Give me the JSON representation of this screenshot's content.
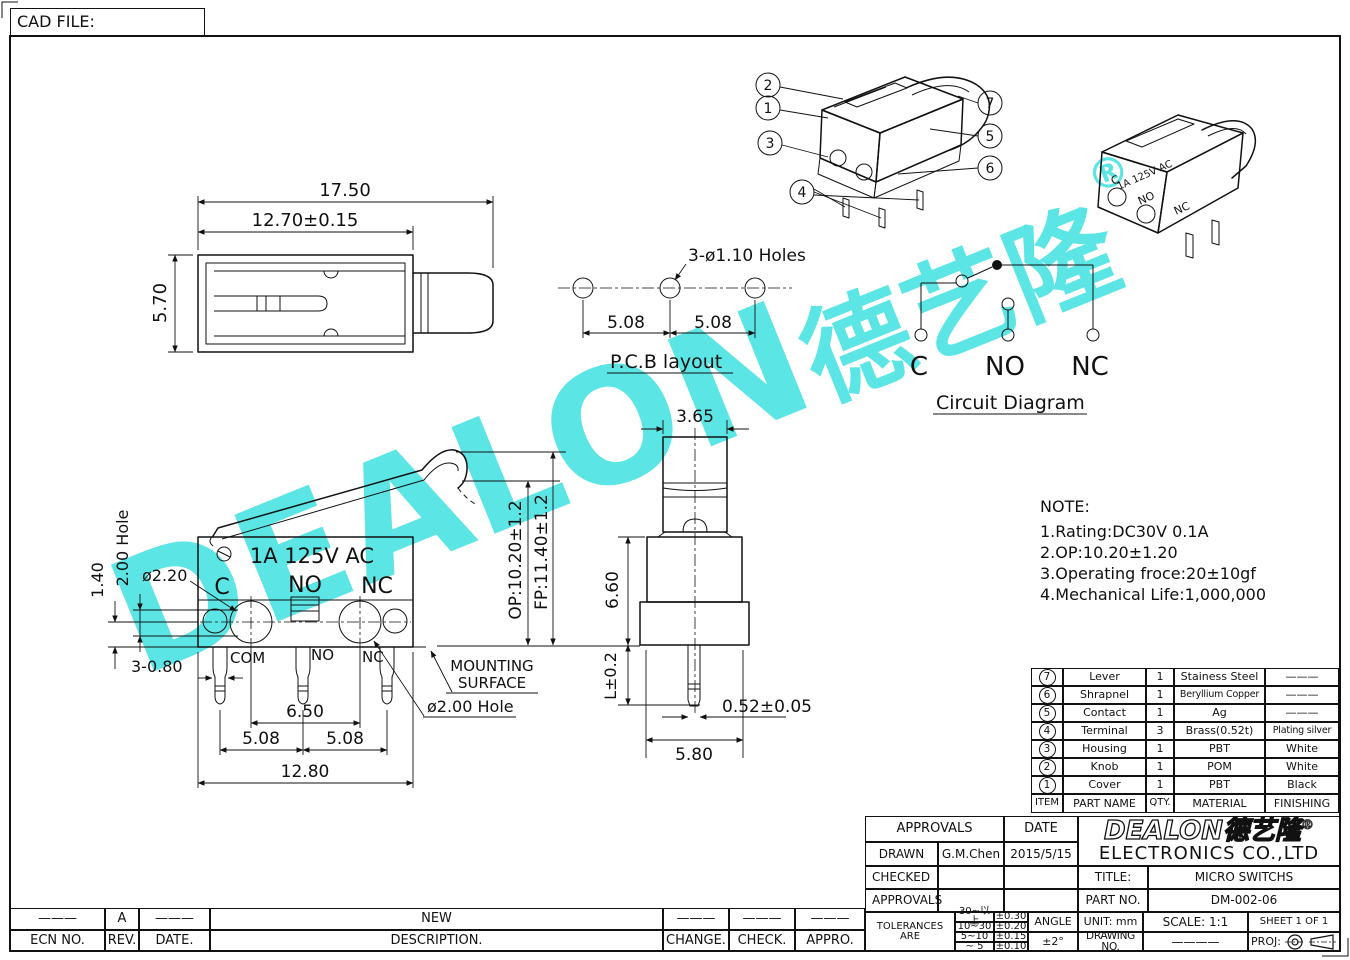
{
  "cad_file": {
    "label": "CAD FILE:"
  },
  "watermark": {
    "text": "DEALON",
    "cjk": "德艺隆",
    "reg": "®",
    "color": "#5ce5e5"
  },
  "callouts": {
    "c1": "1",
    "c2": "2",
    "c3": "3",
    "c4": "4",
    "c5": "5",
    "c6": "6",
    "c7": "7"
  },
  "top_view": {
    "dim_total": "17.50",
    "dim_body": "12.70±0.15",
    "dim_height": "5.70"
  },
  "pcb": {
    "holes": "3-ø1.10 Holes",
    "pitch_left": "5.08",
    "pitch_right": "5.08",
    "caption": "P.C.B layout"
  },
  "circuit": {
    "c": "C",
    "no": "NO",
    "nc": "NC",
    "caption": "Circuit Diagram"
  },
  "main_view": {
    "marking": "1A 125V AC",
    "t_c": "C",
    "t_no": "NO",
    "t_nc": "NC",
    "pin_com": "COM",
    "pin_no": "NO",
    "pin_nc": "NC",
    "dim_140": "1.40",
    "dim_200hole": "2.00 Hole",
    "dim_d220": "ø2.20",
    "dim_3_080": "3-0.80",
    "dim_650": "6.50",
    "dim_508l": "5.08",
    "dim_508r": "5.08",
    "dim_1280": "12.80",
    "mounting_1": "MOUNTING",
    "mounting_2": "SURFACE",
    "dim_d200hole": "ø2.00 Hole"
  },
  "side_view": {
    "dim_365": "3.65",
    "dim_op": "OP:10.20±1.2",
    "dim_fp": "FP:11.40±1.2",
    "dim_660": "6.60",
    "dim_l": "L±0.2",
    "dim_052": "0.52±0.05",
    "dim_580": "5.80"
  },
  "iso2": {
    "marking": "1A 125V AC",
    "c": "C",
    "no": "NO",
    "nc": "NC"
  },
  "note": {
    "title": "NOTE:",
    "line1": "1.Rating:DC30V  0.1A",
    "line2": "2.OP:10.20±1.20",
    "line3": "3.Operating  froce:20±10gf",
    "line4": "4.Mechanical  Life:1,000,000"
  },
  "parts": {
    "headers": {
      "item": "ITEM",
      "name": "PART NAME",
      "qty": "QTY.",
      "material": "MATERIAL",
      "finishing": "FINISHING"
    },
    "rows": [
      {
        "item": "7",
        "name": "Lever",
        "qty": "1",
        "material": "Stainess Steel",
        "finishing": "———"
      },
      {
        "item": "6",
        "name": "Shrapnel",
        "qty": "1",
        "material": "Beryllium Copper",
        "finishing": "———"
      },
      {
        "item": "5",
        "name": "Contact",
        "qty": "1",
        "material": "Ag",
        "finishing": "———"
      },
      {
        "item": "4",
        "name": "Terminal",
        "qty": "3",
        "material": "Brass(0.52t)",
        "finishing": "Plating silver"
      },
      {
        "item": "3",
        "name": "Housing",
        "qty": "1",
        "material": "PBT",
        "finishing": "White"
      },
      {
        "item": "2",
        "name": "Knob",
        "qty": "1",
        "material": "POM",
        "finishing": "White"
      },
      {
        "item": "1",
        "name": "Cover",
        "qty": "1",
        "material": "PBT",
        "finishing": "Black"
      }
    ]
  },
  "title_block": {
    "approvals": "APPROVALS",
    "date": "DATE",
    "drawn": "DRAWN",
    "drawn_by": "G.M.Chen",
    "drawn_date": "2015/5/15",
    "checked": "CHECKED",
    "approvals2": "APPROVALS",
    "tolerances": "TOLERANCES ARE",
    "tol": [
      [
        "30~以上",
        "±0.30"
      ],
      [
        "10~30",
        "±0.20"
      ],
      [
        "5~10",
        "±0.15"
      ],
      [
        "~ 5",
        "±0.10"
      ]
    ],
    "angle": "ANGLE",
    "angle_val": "±2°",
    "logo": "DEALON",
    "logo_cjk": "德艺隆",
    "logo_reg": "®",
    "company": "ELECTRONICS  CO.,LTD",
    "title_label": "TITLE:",
    "title": "MICRO  SWITCHS",
    "part_no_label": "PART NO.",
    "part_no": "DM-002-06",
    "unit": "UNIT:  mm",
    "scale": "SCALE:   1:1",
    "sheet": "SHEET   1 OF 1",
    "drawing_no": "DRAWING  NO.",
    "drawing_no_val": "————",
    "proj": "PROJ:"
  },
  "revision": {
    "row": [
      "———",
      "A",
      "———",
      "NEW",
      "———",
      "———",
      "———"
    ],
    "headers": [
      "ECN NO.",
      "REV.",
      "DATE.",
      "DESCRIPTION.",
      "CHANGE.",
      "CHECK.",
      "APPRO."
    ]
  }
}
